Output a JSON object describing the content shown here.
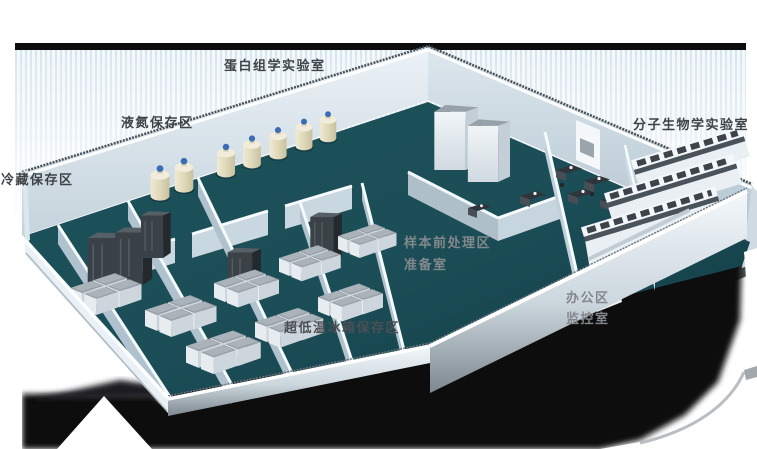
{
  "labels": {
    "proteomics_lab": "蛋白组学实验室",
    "liquid_nitrogen_storage": "液氮保存区",
    "cold_storage": "冷藏保存区",
    "molecular_biology_lab": "分子生物学实验室",
    "sample_pretreatment": "样本前处理区",
    "prep_room": "准备室",
    "office_area": "办公区",
    "monitoring_room": "监控室",
    "ult_freezer_storage": "超低温冰箱保存区"
  },
  "palette": {
    "top_bar": "#0b0d0e",
    "backdrop_stripe": "#d9e5ef",
    "floor_teal": "#1c4f58",
    "wall_light": "#eef4f8",
    "wall_shaded": "#b6c7d1",
    "tank_cream": "#e9e2cc",
    "tank_cap_blue": "#3c6db4",
    "bench_top_gray": "#4b535a",
    "dark_cabinet": "#3a4147",
    "shadow_black": "#0b0d0e",
    "label_dark": "#3e4347",
    "label_on_shadow": "#83888c"
  }
}
